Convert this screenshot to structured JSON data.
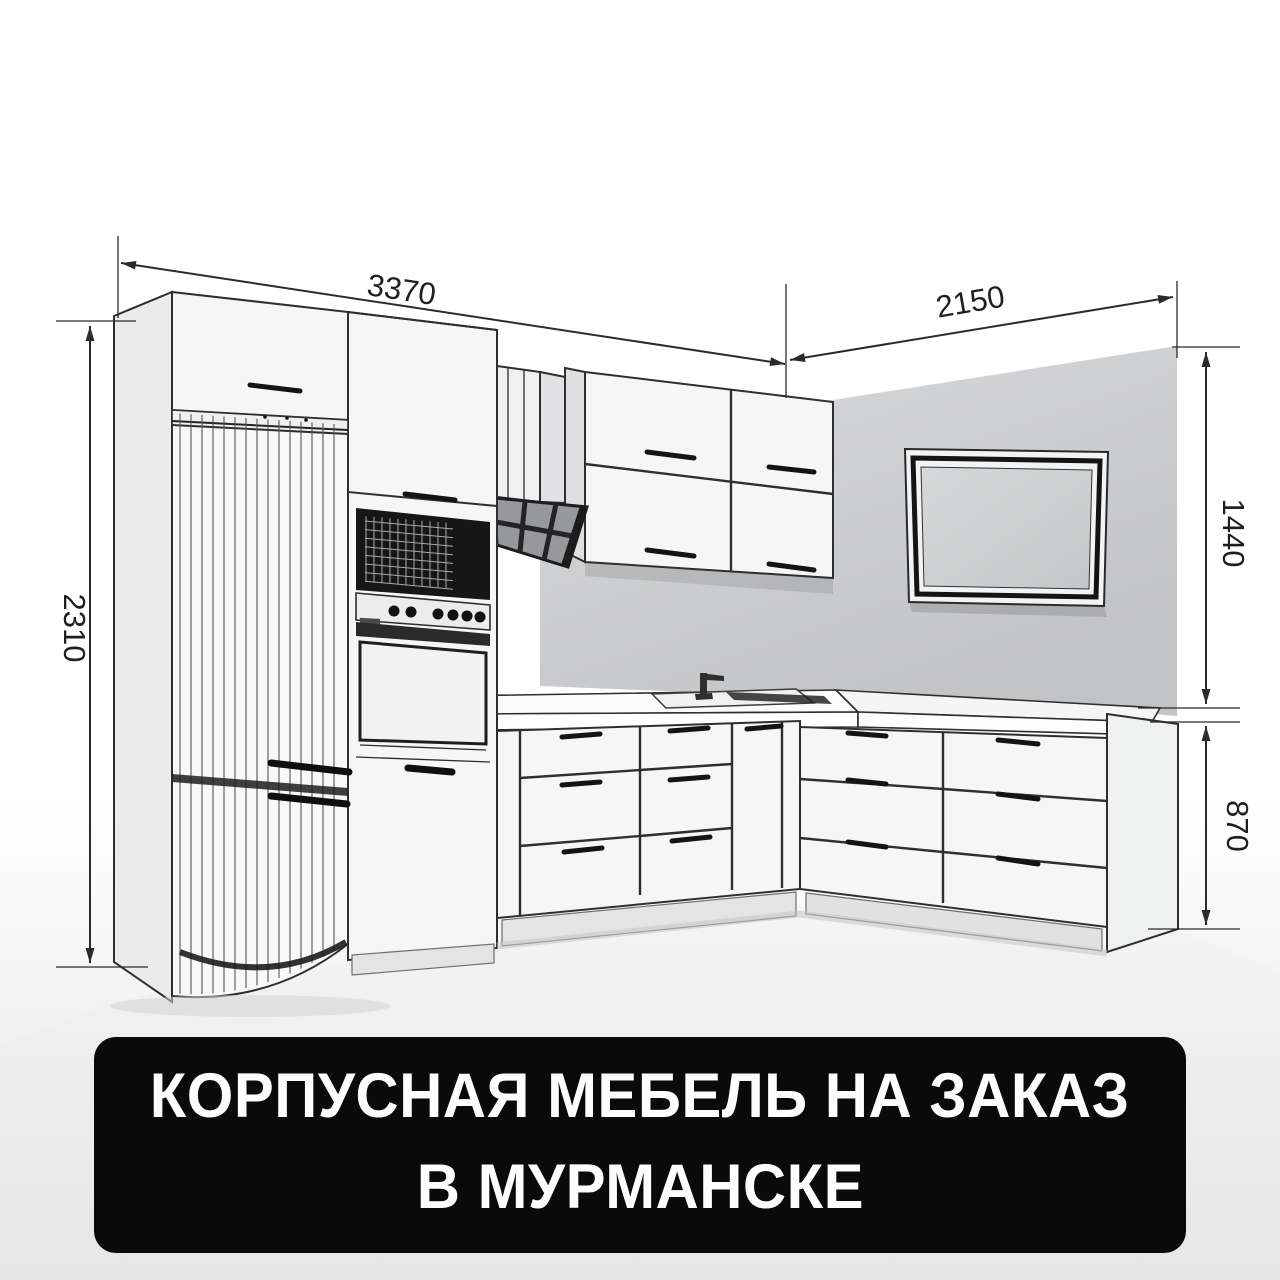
{
  "drawing": {
    "dimensions": {
      "top_left_run": "3370",
      "top_right_run": "2150",
      "column_height": "2310",
      "wall_section_height": "1440",
      "base_section_height": "870"
    },
    "line_color": "#2b2b2b",
    "scene_objects": [
      "fridge-tall-unit",
      "oven-microwave-tower",
      "extractor-hood",
      "hood-duct",
      "wall-cabinets",
      "tv-panel",
      "right-wall",
      "countertop",
      "kitchen-sink",
      "faucet",
      "base-drawer-units",
      "floor"
    ]
  },
  "banner": {
    "line1": "КОРПУСНАЯ МЕБЕЛЬ НА ЗАКАЗ",
    "line2": "В МУРМАНСКЕ",
    "background_color": "#0a0a0a",
    "text_color": "#fdfdfd"
  }
}
